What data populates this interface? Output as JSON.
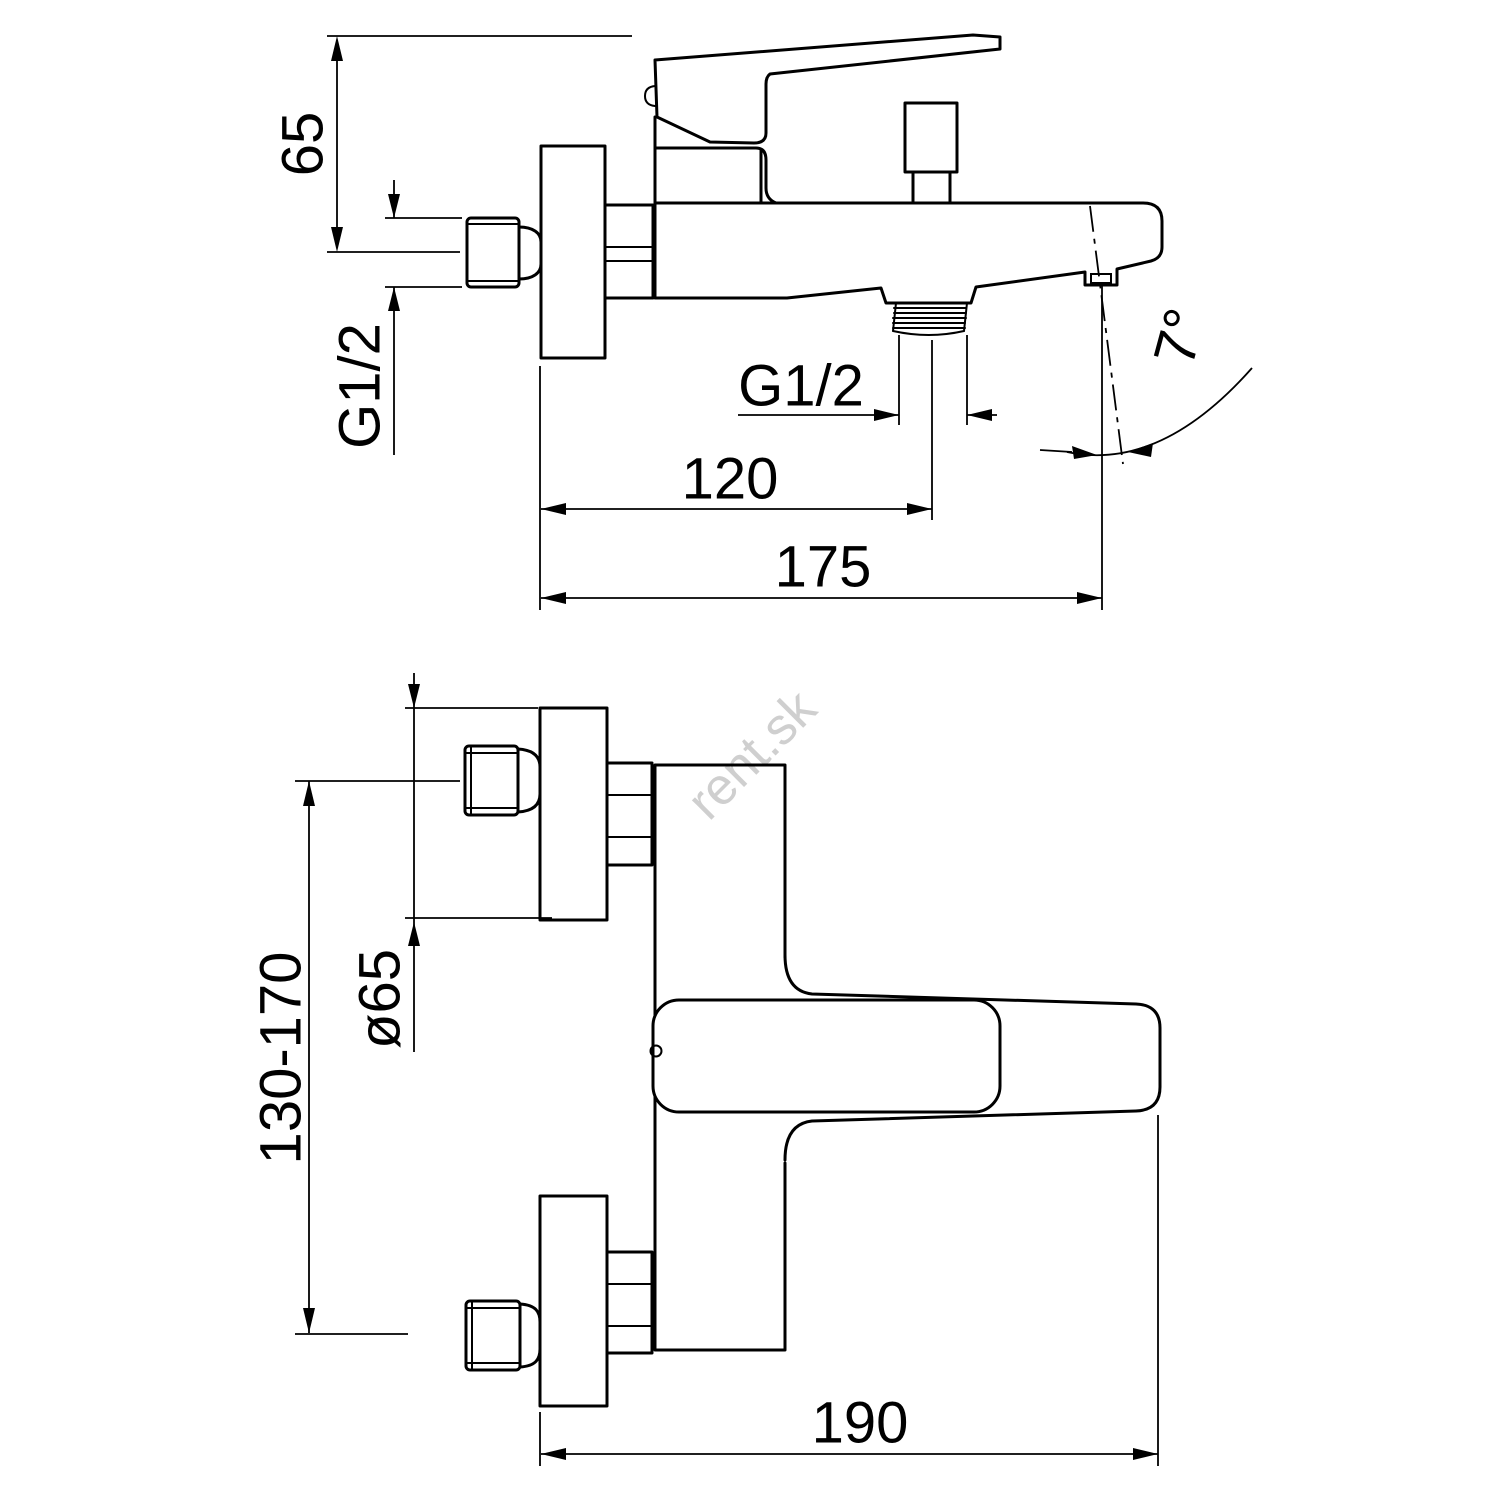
{
  "drawing": {
    "type": "technical-dimension-drawing",
    "subject": "wall-mounted bath mixer faucet",
    "watermark": "rent.sk",
    "colors": {
      "line": "#000000",
      "background": "#ffffff",
      "watermark": "#cfcfcf"
    },
    "side_view": {
      "name": "side-view",
      "dims": {
        "height": "65",
        "wall_thread": "G1/2",
        "outlet_thread": "G1/2",
        "outlet_offset": "120",
        "total_depth": "175",
        "spout_angle": "7°"
      }
    },
    "plan_view": {
      "name": "plan-view",
      "dims": {
        "escutcheon": "ø65",
        "supply_spacing": "130-170",
        "spout_reach": "190"
      }
    }
  }
}
